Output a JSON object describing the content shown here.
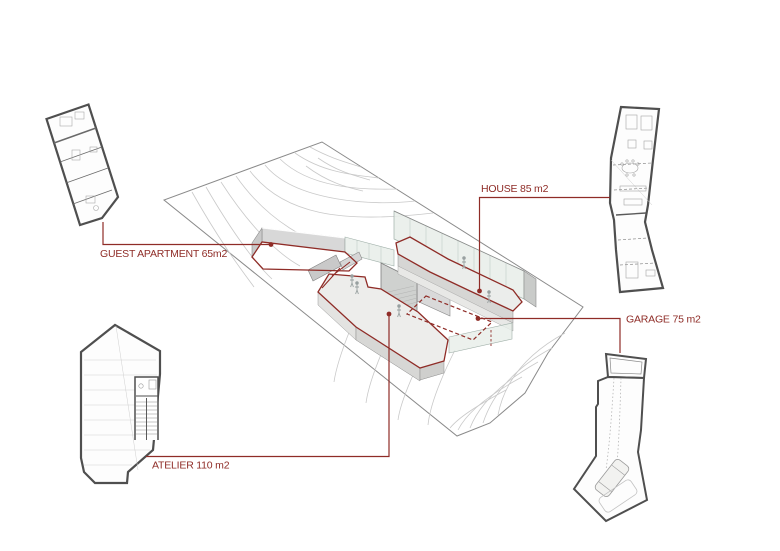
{
  "diagram": {
    "background": "#ffffff",
    "colors": {
      "accent_red": "#8f2c27",
      "line_gray": "#8a8a8a",
      "contour_gray": "#c9c9c9",
      "wall_gray": "#d6d6d4",
      "glass_green": "#e7ede9"
    },
    "callouts": [
      {
        "id": "guest-apartment",
        "label": "GUEST APARTMENT 65m2"
      },
      {
        "id": "house",
        "label": "HOUSE 85 m2"
      },
      {
        "id": "garage",
        "label": "GARAGE 75 m2"
      },
      {
        "id": "atelier",
        "label": "ATELIER 110 m2"
      }
    ]
  }
}
